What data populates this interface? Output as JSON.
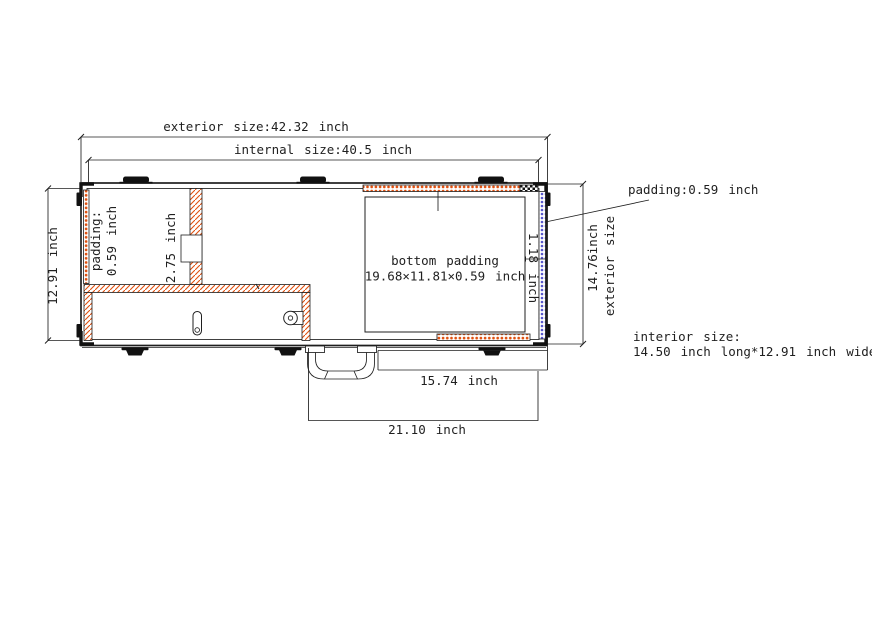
{
  "title": "case interior padding dimension drawing",
  "labels": {
    "exterior_width": "exterior size:42.32 inch",
    "internal_width": "internal size:40.5 inch",
    "left_height": "12.91 inch",
    "side_padding_line1": "padding:",
    "side_padding_line2": "0.59 inch",
    "divider_width": "2.75 inch",
    "bottom_padding_line1": "bottom padding",
    "bottom_padding_line2": "19.68×11.81×0.59 inch",
    "edge_padding_width": "1.18 inch",
    "padding_callout": "padding:0.59 inch",
    "exterior_height_line1": "14.76inch",
    "exterior_height_line2": "exterior size",
    "interior_size_line1": "interior size:",
    "interior_size_line2": "14.50 inch long*12.91 inch wide",
    "handle_side_length": "15.74 inch",
    "bottom_length": "21.10 inch"
  },
  "colors": {
    "line": "#1f1f1f",
    "hatch_orange": "#e0500f",
    "padding_blue": "#5757cc",
    "hardware_black": "#111111"
  }
}
